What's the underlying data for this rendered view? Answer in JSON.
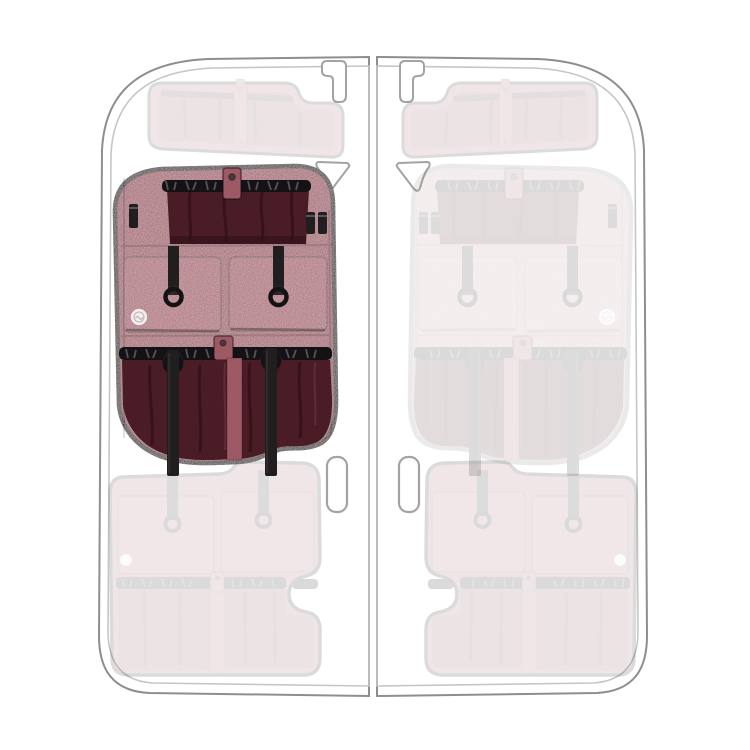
{
  "scene": {
    "name": "van-rear-doors-organizer-position-preview",
    "doors": [
      {
        "id": "left-door",
        "panels": [
          {
            "id": "left-upper-panel",
            "position": "upper",
            "state": "ghosted"
          },
          {
            "id": "left-middle-panel",
            "position": "middle",
            "state": "selected"
          },
          {
            "id": "left-lower-panel",
            "position": "lower",
            "state": "ghosted"
          }
        ]
      },
      {
        "id": "right-door",
        "panels": [
          {
            "id": "right-upper-panel",
            "position": "upper",
            "state": "ghosted"
          },
          {
            "id": "right-middle-panel",
            "position": "middle",
            "state": "ghosted"
          },
          {
            "id": "right-lower-panel",
            "position": "lower",
            "state": "ghosted"
          }
        ]
      }
    ]
  },
  "colors": {
    "background": "#ffffff",
    "door_outline_outer": "#8e8e8e",
    "door_outline_inner": "#c6c6c6",
    "hardware_gray": "#a3a3a3",
    "fabric": "#9e5a64",
    "fabric_light": "#a8646f",
    "fabric_mesh": "#7c4a54",
    "interior_dark": "#4a1c26",
    "interior_shadow": "#321018",
    "binding_black": "#191519",
    "strap_black": "#211e20",
    "elastic_black": "#151215",
    "ruffle_gray": "#575256",
    "badge_white": "#f4efee",
    "badge_glyph": "#bfb2b4"
  },
  "opacities": {
    "ghosted": 0.15,
    "selected": 1
  }
}
